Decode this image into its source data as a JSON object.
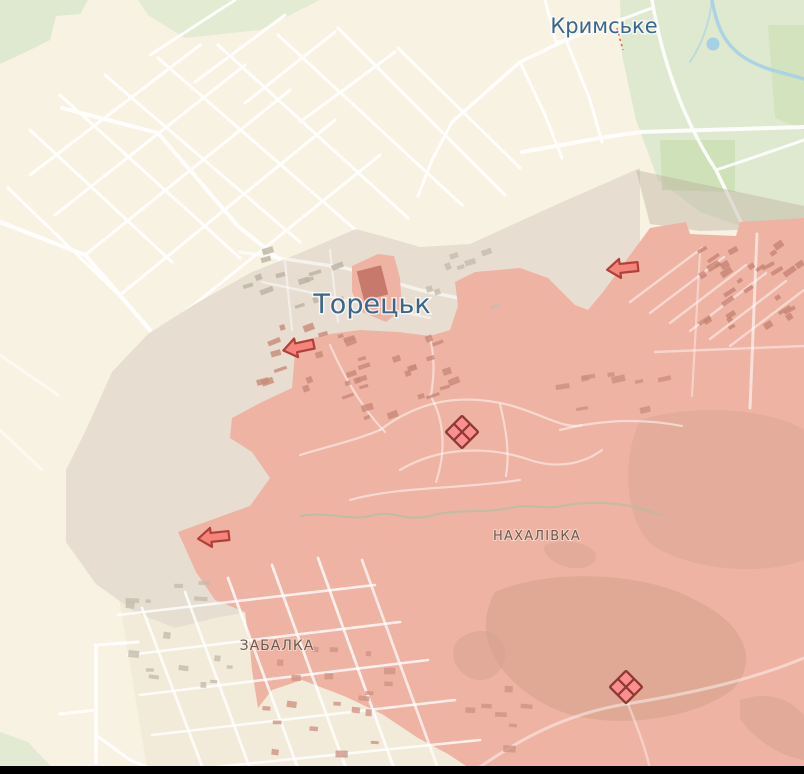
{
  "map": {
    "place_labels": {
      "krymske": "Кримське",
      "toretsk": "Торецьк",
      "nakhalivka": "НАХАЛІВКА",
      "zabalka": "ЗАБАЛКА"
    },
    "markers": {
      "advance_arrows": [
        {
          "x": 300,
          "y": 347,
          "rot": -12,
          "direction": "left"
        },
        {
          "x": 624,
          "y": 268,
          "rot": -6,
          "direction": "left"
        },
        {
          "x": 215,
          "y": 537,
          "rot": -6,
          "direction": "left"
        }
      ],
      "clash_markers": [
        {
          "x": 462,
          "y": 432
        },
        {
          "x": 626,
          "y": 687
        }
      ]
    },
    "colors": {
      "base": "#f8f2e2",
      "urban_tint": "#eee6d4",
      "forest": "#dfe9d0",
      "forest_dark": "#cbdfb3",
      "water": "#a6d0e6",
      "road": "#ffffff",
      "contested_fill": "#e5dccf",
      "contested_over_forest": "#b9ab9b",
      "occupied_fill": "#eeb3a3",
      "occupied_dark": "#d5a28d",
      "stream": "#b2bfa2",
      "label_city": "#38678f",
      "label_district": "#6b5b53",
      "arrow_fill": "#f5857c",
      "arrow_stroke": "#b04038",
      "marker_fill": "#fb8f8f",
      "marker_stroke": "#8e3a32",
      "trail_dashed": "#dd6b5e",
      "letterbox": "#000000"
    }
  }
}
